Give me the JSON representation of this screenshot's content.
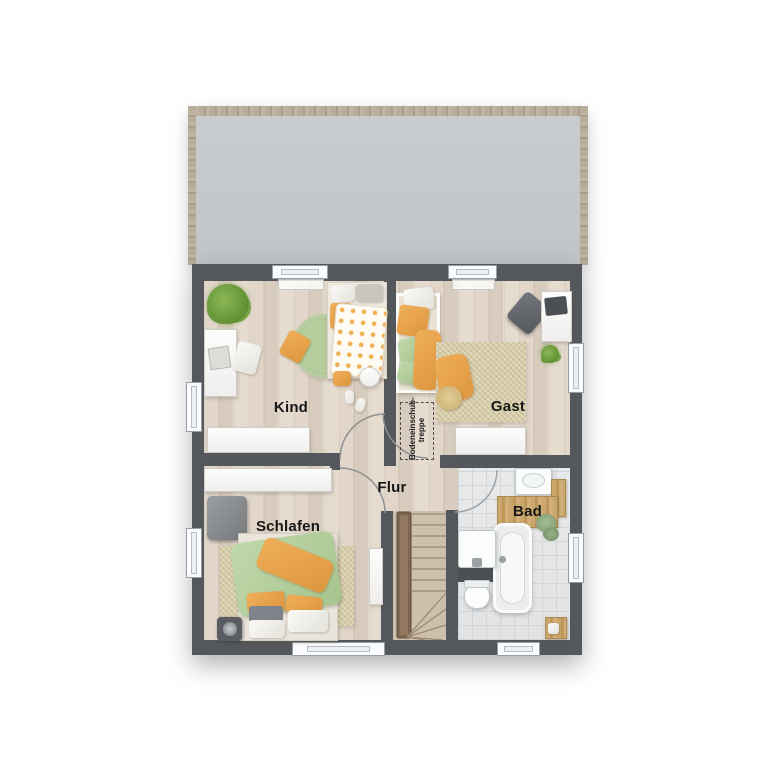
{
  "floorplan": {
    "rooms": {
      "kind": {
        "label": "Kind"
      },
      "gast": {
        "label": "Gast"
      },
      "flur": {
        "label": "Flur"
      },
      "schlafen": {
        "label": "Schlafen"
      },
      "bad": {
        "label": "Bad"
      }
    },
    "annotations": {
      "attic_stairs": {
        "line1": "Bodeneinschub-",
        "line2": "treppe"
      }
    },
    "colors": {
      "wall": "#54585c",
      "wood_floor": "#ddd2c5",
      "tile_floor": "#e3e5e6",
      "roof_fill": "#c7cacc",
      "roof_trim": "#b4aa96",
      "stair_floor": "#cfc1af",
      "accent_orange": "#e8a24e",
      "accent_green": "#aec79a",
      "rug_beige": "#d6cba5",
      "window": "#fbfcfd"
    }
  }
}
